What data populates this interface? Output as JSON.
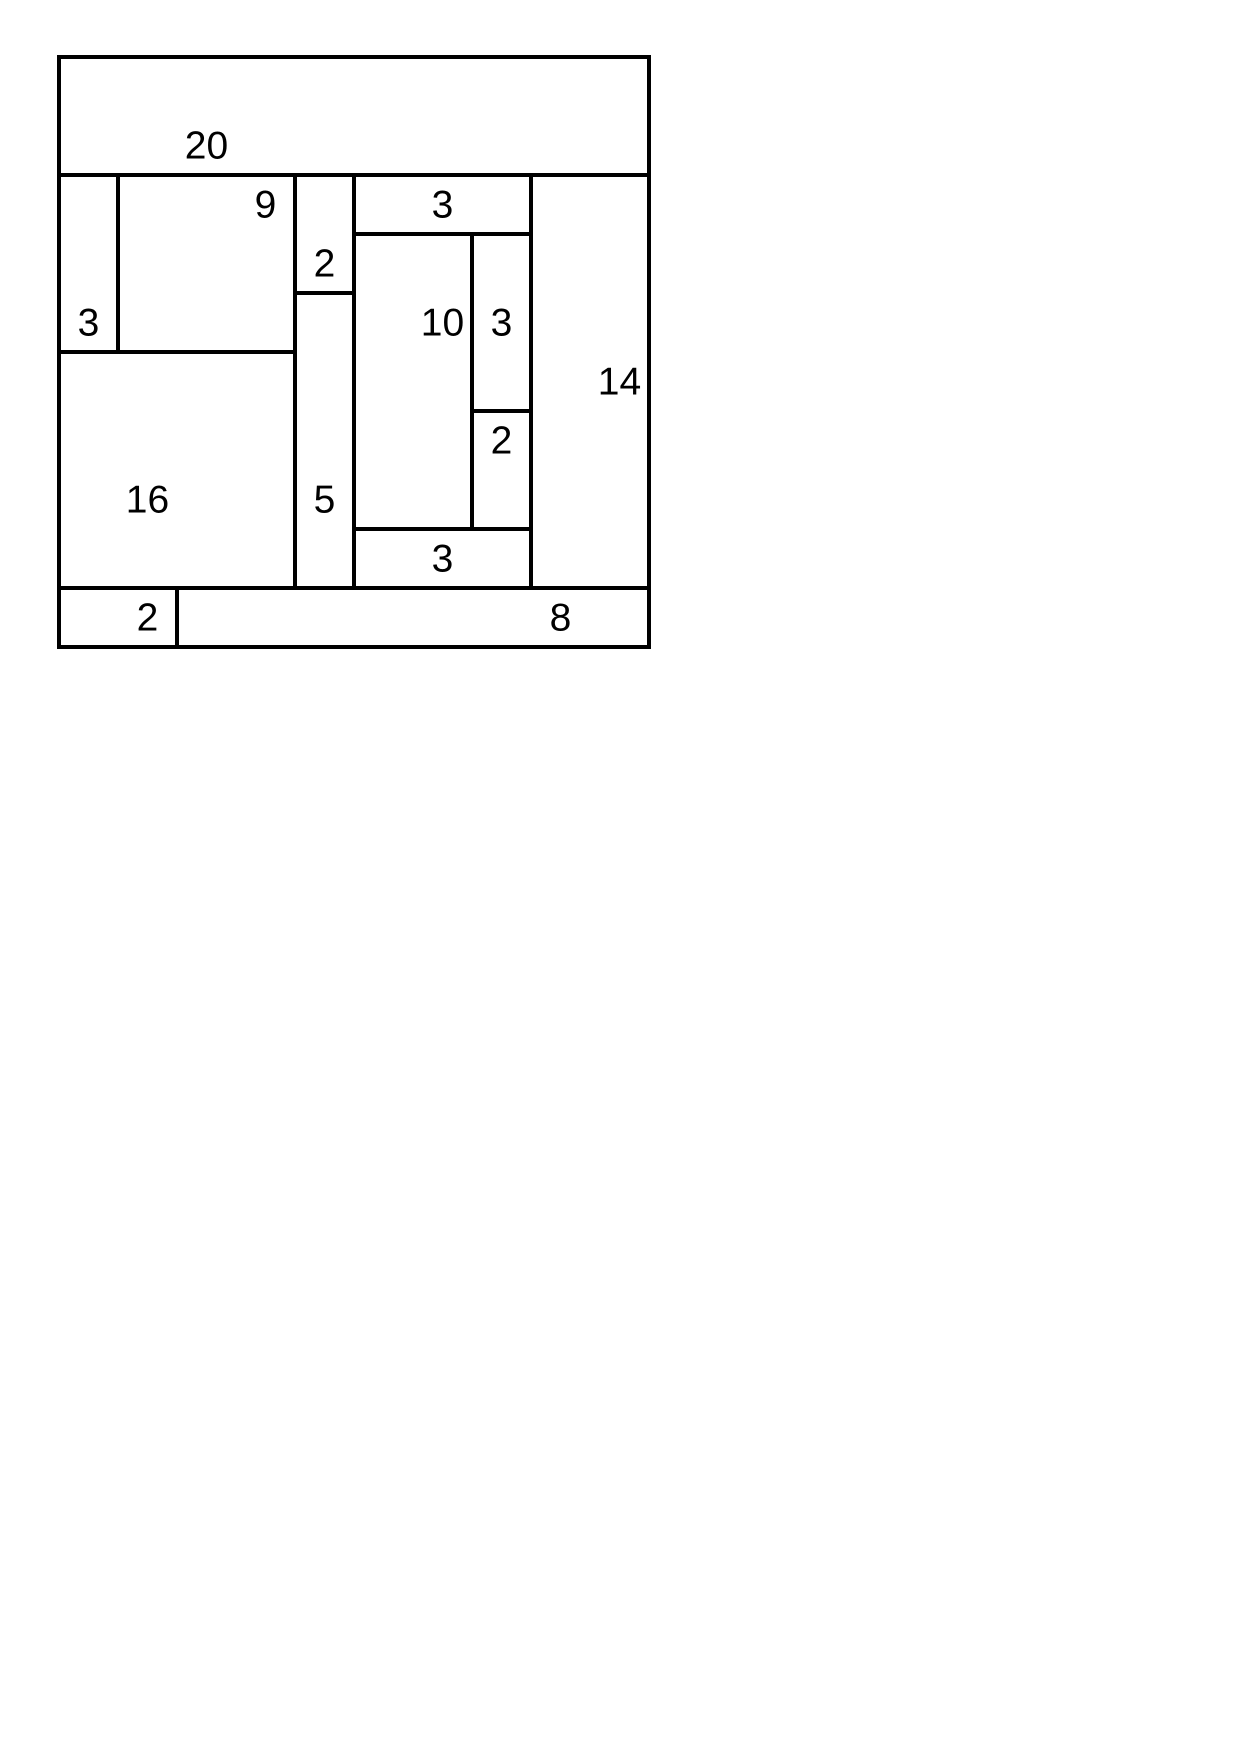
{
  "figure": {
    "type": "rectangle-area-partition-puzzle",
    "grid_units": 10,
    "unit_px": 59,
    "origin_px": {
      "x": 59,
      "y": 57
    },
    "stroke_px": 4,
    "stroke_color": "#000000",
    "background_color": "#ffffff",
    "total_area": 100,
    "rectangles": [
      {
        "label": "20",
        "x": 0,
        "y": 0,
        "w": 10,
        "h": 2,
        "label_cx": 2.5,
        "label_cy": 1.5
      },
      {
        "label": "3",
        "x": 0,
        "y": 2,
        "w": 1,
        "h": 3,
        "label_cx": 0.5,
        "label_cy": 4.5
      },
      {
        "label": "9",
        "x": 1,
        "y": 2,
        "w": 3,
        "h": 3,
        "label_cx": 3.5,
        "label_cy": 2.5
      },
      {
        "label": "2",
        "x": 4,
        "y": 2,
        "w": 1,
        "h": 2,
        "label_cx": 4.5,
        "label_cy": 3.5
      },
      {
        "label": "3",
        "x": 5,
        "y": 2,
        "w": 3,
        "h": 1,
        "label_cx": 6.5,
        "label_cy": 2.5
      },
      {
        "label": "14",
        "x": 8,
        "y": 2,
        "w": 2,
        "h": 7,
        "label_cx": 9.5,
        "label_cy": 5.5
      },
      {
        "label": "10",
        "x": 5,
        "y": 3,
        "w": 2,
        "h": 5,
        "label_cx": 6.5,
        "label_cy": 4.5
      },
      {
        "label": "3",
        "x": 7,
        "y": 3,
        "w": 1,
        "h": 3,
        "label_cx": 7.5,
        "label_cy": 4.5
      },
      {
        "label": "2",
        "x": 7,
        "y": 6,
        "w": 1,
        "h": 2,
        "label_cx": 7.5,
        "label_cy": 6.5
      },
      {
        "label": "5",
        "x": 4,
        "y": 4,
        "w": 1,
        "h": 5,
        "label_cx": 4.5,
        "label_cy": 7.5
      },
      {
        "label": "16",
        "x": 0,
        "y": 5,
        "w": 4,
        "h": 4,
        "label_cx": 1.5,
        "label_cy": 7.5
      },
      {
        "label": "3",
        "x": 5,
        "y": 8,
        "w": 3,
        "h": 1,
        "label_cx": 6.5,
        "label_cy": 8.5
      },
      {
        "label": "2",
        "x": 0,
        "y": 9,
        "w": 2,
        "h": 1,
        "label_cx": 1.5,
        "label_cy": 9.5
      },
      {
        "label": "8",
        "x": 2,
        "y": 9,
        "w": 8,
        "h": 1,
        "label_cx": 8.5,
        "label_cy": 9.5
      }
    ]
  }
}
